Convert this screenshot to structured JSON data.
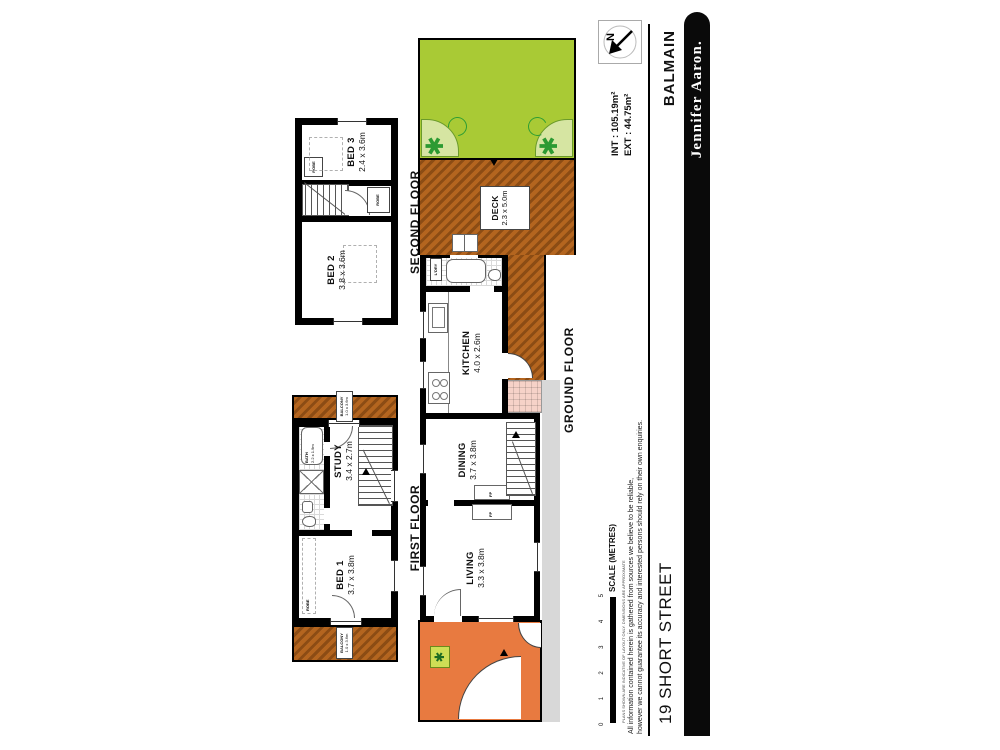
{
  "title": {
    "address": "19 SHORT STREET",
    "suburb": "BALMAIN",
    "brand": "Jennifer Aaron."
  },
  "areas": {
    "int": "INT : 105.19m²",
    "ext": "EXT :  44.75m²"
  },
  "compass": {
    "north": "N"
  },
  "scale": {
    "label": "SCALE (METRES)",
    "t0": "0",
    "t1": "1",
    "t2": "2",
    "t3": "3",
    "t4": "4",
    "t5": "5"
  },
  "disclaimer": {
    "micro": "PLANS SHOWN ARE INDICATIVE OF LAYOUT ONLY. DIMENSIONS ARE APPROXIMATE",
    "l1": "All information contained herein is gathered from sources we believe to be reliable,",
    "l2": "however we cannot guarantee its accuracy and interested persons should rely on their own enquiries."
  },
  "floors": {
    "ground": {
      "label": "GROUND FLOOR",
      "living_name": "LIVING",
      "living_dim": "3.3 x 3.8m",
      "dining_name": "DINING",
      "dining_dim": "3.7 x 3.8m",
      "kitchen_name": "KITCHEN",
      "kitchen_dim": "4.0 x 2.6m",
      "deck_name": "DECK",
      "deck_dim": "2.3 x 5.0m",
      "laundry": "L'DRY",
      "fp": "FP"
    },
    "first": {
      "label": "FIRST FLOOR",
      "bed1_name": "BED 1",
      "bed1_dim": "3.7 x 3.8m",
      "study_name": "STUDY",
      "study_dim": "3.4 x 2.7m",
      "bath_name": "BATH",
      "bath_dim": "2.2 x 1.9m",
      "robe": "ROBE",
      "balcony_name": "BALCONY",
      "balcony_dim": "1.0 x 3.6m"
    },
    "second": {
      "label": "SECOND FLOOR",
      "bed2_name": "BED 2",
      "bed2_dim": "3.8 x 3.6m",
      "bed3_name": "BED 3",
      "bed3_dim": "2.4 x 3.6m",
      "robe": "ROBE"
    }
  },
  "colors": {
    "lawn": "#a9ca35",
    "deck": "#a95c1c",
    "paving": "#e87a40",
    "neighbour": "#d8d8d8",
    "ink": "#000000"
  }
}
